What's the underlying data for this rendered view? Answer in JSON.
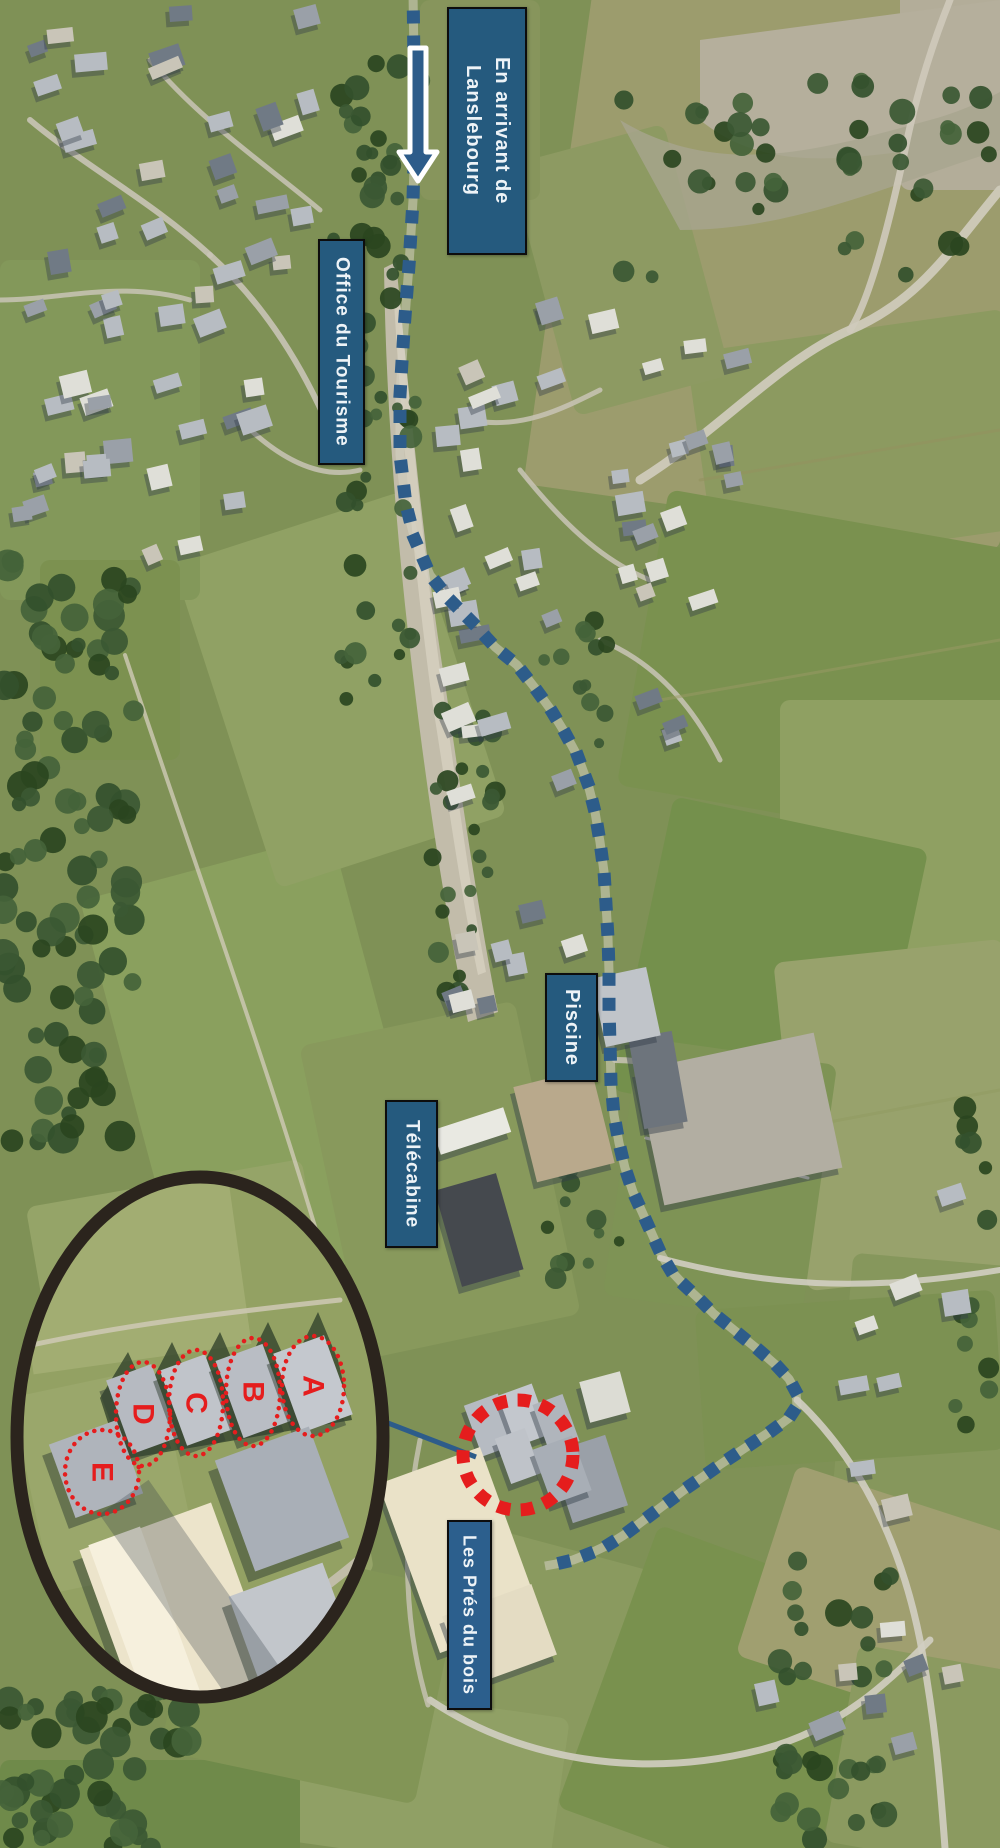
{
  "labels": {
    "arrival": {
      "line1": "En arrivant de",
      "line2": "Lanslebourg"
    },
    "tourism_office": "Office du Tourisme",
    "pool": "Piscine",
    "gondola": "Télécabine",
    "residence": "Les Prés du bois"
  },
  "colors": {
    "label_bg": "#255a7e",
    "label_bg_residence": "#2c5f8d",
    "label_text": "#edf3f7",
    "route_blue": "#2d5c8a",
    "marker_red": "#e51d1d",
    "magnifier_ring": "#2b241d",
    "arrow_fill": "#2d5c8a",
    "arrow_outline": "#ffffff"
  },
  "map": {
    "width": 1000,
    "height": 1848,
    "route": {
      "dash": 13,
      "step": 25,
      "waypoints": [
        [
          413,
          -8
        ],
        [
          414,
          60
        ],
        [
          415,
          130
        ],
        [
          413,
          200
        ],
        [
          409,
          265
        ],
        [
          404,
          330
        ],
        [
          400,
          395
        ],
        [
          400,
          455
        ],
        [
          406,
          505
        ],
        [
          415,
          540
        ],
        [
          430,
          575
        ],
        [
          450,
          600
        ],
        [
          472,
          622
        ],
        [
          495,
          647
        ],
        [
          517,
          665
        ],
        [
          535,
          688
        ],
        [
          551,
          710
        ],
        [
          565,
          733
        ],
        [
          578,
          757
        ],
        [
          588,
          784
        ],
        [
          595,
          812
        ],
        [
          600,
          842
        ],
        [
          604,
          872
        ],
        [
          606,
          904
        ],
        [
          608,
          938
        ],
        [
          609,
          972
        ],
        [
          609,
          1008
        ],
        [
          610,
          1045
        ],
        [
          611,
          1082
        ],
        [
          614,
          1115
        ],
        [
          619,
          1143
        ],
        [
          625,
          1168
        ],
        [
          633,
          1192
        ],
        [
          643,
          1214
        ],
        [
          652,
          1234
        ],
        [
          661,
          1254
        ],
        [
          671,
          1271
        ],
        [
          684,
          1285
        ],
        [
          699,
          1299
        ],
        [
          714,
          1314
        ],
        [
          729,
          1326
        ],
        [
          745,
          1339
        ],
        [
          761,
          1352
        ],
        [
          777,
          1366
        ],
        [
          789,
          1379
        ],
        [
          796,
          1392
        ],
        [
          797,
          1406
        ],
        [
          789,
          1418
        ],
        [
          774,
          1429
        ],
        [
          757,
          1440
        ],
        [
          739,
          1452
        ],
        [
          721,
          1464
        ],
        [
          704,
          1476
        ],
        [
          688,
          1487
        ],
        [
          672,
          1499
        ],
        [
          656,
          1511
        ],
        [
          640,
          1523
        ],
        [
          624,
          1535
        ],
        [
          608,
          1545
        ],
        [
          591,
          1553
        ],
        [
          573,
          1560
        ],
        [
          556,
          1564
        ],
        [
          545,
          1566
        ]
      ]
    },
    "arrow": {
      "points": "410,48 426,48 426,152 437,152 418,181 399,152 410,152"
    },
    "red_circle": {
      "cx": 518,
      "cy": 1455,
      "r": 55,
      "sw": 13,
      "dash": "13 10.5"
    },
    "connector": {
      "x1": 349,
      "y1": 1408,
      "x2": 476,
      "y2": 1457,
      "w": 5
    },
    "fields": [
      {
        "x": 560,
        "y": -40,
        "w": 480,
        "h": 560,
        "rot": 8,
        "f": "#9c9c6d"
      },
      {
        "x": 900,
        "y": -10,
        "w": 110,
        "h": 200,
        "rot": 0,
        "f": "#b3ad99"
      },
      {
        "x": 700,
        "y": 330,
        "w": 320,
        "h": 220,
        "rot": -8,
        "f": "#8c9a60"
      },
      {
        "x": 640,
        "y": 520,
        "w": 380,
        "h": 300,
        "rot": 10,
        "f": "#7a914f"
      },
      {
        "x": 780,
        "y": 700,
        "w": 240,
        "h": 260,
        "rot": 0,
        "f": "#8fa062"
      },
      {
        "x": 640,
        "y": 820,
        "w": 260,
        "h": 300,
        "rot": 12,
        "f": "#74904c"
      },
      {
        "x": 790,
        "y": 950,
        "w": 230,
        "h": 330,
        "rot": -6,
        "f": "#98a26c"
      },
      {
        "x": 620,
        "y": 1050,
        "w": 200,
        "h": 260,
        "rot": 8,
        "f": "#7e9355"
      },
      {
        "x": 840,
        "y": 1260,
        "w": 180,
        "h": 300,
        "rot": 5,
        "f": "#86975c"
      },
      {
        "x": 700,
        "y": 1300,
        "w": 300,
        "h": 160,
        "rot": -4,
        "f": "#7c9152"
      },
      {
        "x": 430,
        "y": 1560,
        "w": 320,
        "h": 300,
        "rot": 15,
        "f": "#8a9a5f"
      },
      {
        "x": 600,
        "y": 1560,
        "w": 260,
        "h": 300,
        "rot": 20,
        "f": "#79914e"
      },
      {
        "x": 760,
        "y": 1500,
        "w": 260,
        "h": 200,
        "rot": 18,
        "f": "#a09f70"
      },
      {
        "x": 840,
        "y": 1660,
        "w": 200,
        "h": 200,
        "rot": 10,
        "f": "#8b9a60"
      },
      {
        "x": 300,
        "y": 1700,
        "w": 260,
        "h": 160,
        "rot": 8,
        "f": "#90a065"
      },
      {
        "x": 0,
        "y": 1760,
        "w": 300,
        "h": 100,
        "rot": 0,
        "f": "#6f8a4a"
      },
      {
        "x": 130,
        "y": 860,
        "w": 260,
        "h": 420,
        "rot": -15,
        "f": "#8aa05e"
      },
      {
        "x": 60,
        "y": 1180,
        "w": 280,
        "h": 420,
        "rot": -10,
        "f": "#95a468"
      },
      {
        "x": 330,
        "y": 1020,
        "w": 220,
        "h": 320,
        "rot": -12,
        "f": "#88995c"
      },
      {
        "x": 220,
        "y": 520,
        "w": 240,
        "h": 340,
        "rot": -18,
        "f": "#90a164"
      },
      {
        "x": 0,
        "y": 260,
        "w": 200,
        "h": 340,
        "rot": 0,
        "f": "#83985a"
      },
      {
        "x": 540,
        "y": 140,
        "w": 160,
        "h": 260,
        "rot": -15,
        "f": "#8d9a62"
      },
      {
        "x": 420,
        "y": 0,
        "w": 120,
        "h": 200,
        "rot": 0,
        "f": "#87955c"
      },
      {
        "x": 180,
        "y": 1560,
        "w": 260,
        "h": 220,
        "rot": 12,
        "f": "#829556"
      },
      {
        "x": 40,
        "y": 560,
        "w": 140,
        "h": 200,
        "rot": 0,
        "f": "#7c9150"
      }
    ],
    "scree": [
      {
        "d": "M396,262 C410,400 422,540 446,690 C462,800 478,910 498,1012 L468,1022 C448,926 432,828 416,700 C398,556 386,412 384,268 Z",
        "f": "#c2bcaa",
        "o": 1
      },
      {
        "d": "M400,300 C412,430 424,560 444,698 C458,798 470,888 486,972 L478,975 C460,890 448,800 432,700 C414,566 402,436 394,302 Z",
        "f": "#d8d3c2",
        "o": 0.75
      },
      {
        "d": "M700,40 L1000,0 L1000,140 C880,150 780,185 700,120 Z",
        "f": "#b5af9c",
        "o": 1
      },
      {
        "d": "M620,120 C720,180 820,150 930,120 C960,112 985,100 1000,92 L1000,150 C900,180 800,230 680,230 Z",
        "f": "#a8a58e",
        "o": 0.8
      }
    ],
    "roads": [
      {
        "d": "M640,480 C720,430 780,360 850,330 C920,300 950,250 1000,190",
        "w": 9,
        "c": "#cfcabb",
        "o": 0.95
      },
      {
        "d": "M850,330 C870,300 890,220 905,150 C915,100 930,50 950,0",
        "w": 7,
        "c": "#cfcabb",
        "o": 0.9
      },
      {
        "d": "M660,1258 C780,1290 880,1290 1000,1270",
        "w": 6,
        "c": "#d2cec2",
        "o": 0.9
      },
      {
        "d": "M797,1400 C860,1460 900,1540 920,1640 C935,1720 940,1780 945,1848",
        "w": 7,
        "c": "#d2cec2",
        "o": 0.9
      },
      {
        "d": "M430,1700 C520,1760 640,1780 760,1750 C840,1730 890,1680 930,1640",
        "w": 7,
        "c": "#d2cec2",
        "o": 0.9
      },
      {
        "d": "M125,655 C200,880 280,1100 335,1295",
        "w": 4,
        "c": "#d0cab6",
        "o": 0.8
      },
      {
        "d": "M30,120 C90,170 150,200 210,255",
        "w": 6,
        "c": "#c9c4b6",
        "o": 0.9
      },
      {
        "d": "M210,255 C260,300 300,360 330,430",
        "w": 6,
        "c": "#c9c4b6",
        "o": 0.9
      },
      {
        "d": "M150,60 C200,120 260,160 320,210",
        "w": 5,
        "c": "#c9c4b6",
        "o": 0.85
      },
      {
        "d": "M0,300 C60,300 120,280 190,300",
        "w": 5,
        "c": "#c9c4b6",
        "o": 0.85
      },
      {
        "d": "M240,420 C280,460 320,480 360,470",
        "w": 5,
        "c": "#c9c4b6",
        "o": 0.85
      },
      {
        "d": "M470,420 C520,430 560,410 600,390",
        "w": 5,
        "c": "#c9c4b6",
        "o": 0.85
      },
      {
        "d": "M520,470 C560,520 600,560 650,580",
        "w": 5,
        "c": "#c9c4b6",
        "o": 0.85
      },
      {
        "d": "M600,640 C650,660 690,700 720,760",
        "w": 5,
        "c": "#c9c4b6",
        "o": 0.85
      },
      {
        "d": "M615,1060 C650,1060 680,1070 700,1090",
        "w": 6,
        "c": "#c9c4b6",
        "o": 0.85
      },
      {
        "d": "M420,1440 C400,1540 405,1630 428,1705",
        "w": 5,
        "c": "#c9c4b6",
        "o": 0.8
      },
      {
        "d": "M658,1072 L820,1112",
        "w": 3,
        "c": "#dad7cd",
        "o": 0.9
      },
      {
        "d": "M654,1094 L816,1134",
        "w": 3,
        "c": "#dad7cd",
        "o": 0.9
      },
      {
        "d": "M650,1116 L812,1156",
        "w": 3,
        "c": "#dad7cd",
        "o": 0.9
      },
      {
        "d": "M646,1138 L808,1178",
        "w": 3,
        "c": "#dad7cd",
        "o": 0.9
      },
      {
        "d": "M700,480 L1000,430",
        "w": 3,
        "c": "#93935f",
        "o": 0.6
      },
      {
        "d": "M660,700 L1000,640",
        "w": 3,
        "c": "#9a9a66",
        "o": 0.5
      },
      {
        "d": "M680,1150 L1000,1090",
        "w": 3,
        "c": "#8f9a60",
        "o": 0.5
      }
    ],
    "forest": [
      {
        "x": 0,
        "y": 560,
        "w": 135,
        "h": 585,
        "n": 95,
        "rmin": 7,
        "rmax": 16,
        "seed": 11
      },
      {
        "x": 0,
        "y": 1690,
        "w": 190,
        "h": 158,
        "n": 48,
        "rmin": 8,
        "rmax": 16,
        "seed": 22
      },
      {
        "x": 330,
        "y": 300,
        "w": 90,
        "h": 400,
        "n": 36,
        "rmin": 5,
        "rmax": 12,
        "seed": 33
      },
      {
        "x": 430,
        "y": 700,
        "w": 70,
        "h": 300,
        "n": 26,
        "rmin": 5,
        "rmax": 11,
        "seed": 44
      },
      {
        "x": 330,
        "y": 60,
        "w": 90,
        "h": 240,
        "n": 26,
        "rmin": 6,
        "rmax": 13,
        "seed": 55
      },
      {
        "x": 770,
        "y": 1550,
        "w": 120,
        "h": 298,
        "n": 32,
        "rmin": 7,
        "rmax": 14,
        "seed": 66
      },
      {
        "x": 540,
        "y": 620,
        "w": 80,
        "h": 140,
        "n": 12,
        "rmin": 5,
        "rmax": 11,
        "seed": 77
      },
      {
        "x": 545,
        "y": 1160,
        "w": 75,
        "h": 160,
        "n": 12,
        "rmin": 5,
        "rmax": 11,
        "seed": 88
      },
      {
        "x": 620,
        "y": 80,
        "w": 380,
        "h": 200,
        "n": 42,
        "rmin": 6,
        "rmax": 13,
        "seed": 99
      },
      {
        "x": 955,
        "y": 1080,
        "w": 45,
        "h": 420,
        "n": 14,
        "rmin": 6,
        "rmax": 12,
        "seed": 17
      }
    ],
    "clusters": [
      {
        "x": 5,
        "y": 5,
        "w": 315,
        "h": 515,
        "n": 46,
        "wmin": 16,
        "wmax": 34,
        "hmin": 12,
        "hmax": 24,
        "seed": 101
      },
      {
        "x": 430,
        "y": 290,
        "w": 260,
        "h": 520,
        "n": 32,
        "wmin": 16,
        "wmax": 32,
        "hmin": 12,
        "hmax": 24,
        "seed": 202
      },
      {
        "x": 610,
        "y": 330,
        "w": 150,
        "h": 280,
        "n": 14,
        "wmin": 14,
        "wmax": 28,
        "hmin": 12,
        "hmax": 22,
        "seed": 303
      },
      {
        "x": 440,
        "y": 830,
        "w": 170,
        "h": 220,
        "n": 10,
        "wmin": 14,
        "wmax": 28,
        "hmin": 12,
        "hmax": 22,
        "seed": 404
      },
      {
        "x": 740,
        "y": 1555,
        "w": 260,
        "h": 200,
        "n": 8,
        "wmin": 18,
        "wmax": 34,
        "hmin": 14,
        "hmax": 24,
        "seed": 505
      },
      {
        "x": 830,
        "y": 1150,
        "w": 170,
        "h": 380,
        "n": 8,
        "wmin": 18,
        "wmax": 34,
        "hmin": 14,
        "hmax": 26,
        "seed": 606
      },
      {
        "x": 0,
        "y": 450,
        "w": 220,
        "h": 120,
        "n": 8,
        "wmin": 16,
        "wmax": 30,
        "hmin": 12,
        "hmax": 20,
        "seed": 707
      }
    ],
    "special": [
      {
        "x": 435,
        "y": 1118,
        "w": 74,
        "h": 26,
        "rot": -18,
        "f": "#e9e9e2"
      },
      {
        "x": 447,
        "y": 1180,
        "w": 64,
        "h": 100,
        "rot": -16,
        "f": "#45494e"
      },
      {
        "x": 524,
        "y": 1076,
        "w": 80,
        "h": 98,
        "rot": -14,
        "f": "#b9a98c"
      },
      {
        "x": 648,
        "y": 1050,
        "w": 182,
        "h": 138,
        "rot": -12,
        "f": "#b2aea2"
      },
      {
        "x": 636,
        "y": 1034,
        "w": 44,
        "h": 92,
        "rot": -10,
        "f": "#6d747c"
      },
      {
        "x": 598,
        "y": 972,
        "w": 56,
        "h": 70,
        "rot": -12,
        "f": "#c0c4c9"
      },
      {
        "x": 560,
        "y": 1442,
        "w": 58,
        "h": 74,
        "rot": -18,
        "f": "#9aa0a8"
      },
      {
        "x": 472,
        "y": 1398,
        "w": 36,
        "h": 54,
        "rot": -20,
        "f": "#b6bbc2"
      },
      {
        "x": 506,
        "y": 1388,
        "w": 36,
        "h": 54,
        "rot": -20,
        "f": "#c3c7cd"
      },
      {
        "x": 540,
        "y": 1398,
        "w": 32,
        "h": 50,
        "rot": -20,
        "f": "#b0b5bc"
      },
      {
        "x": 502,
        "y": 1432,
        "w": 32,
        "h": 48,
        "rot": -20,
        "f": "#bfc3c9"
      },
      {
        "x": 541,
        "y": 1441,
        "w": 42,
        "h": 58,
        "rot": -20,
        "f": "#a8aeb6"
      },
      {
        "x": 406,
        "y": 1460,
        "w": 108,
        "h": 180,
        "rot": -20,
        "f": "#eae2c8"
      },
      {
        "x": 452,
        "y": 1598,
        "w": 95,
        "h": 75,
        "rot": -20,
        "f": "#e4dcc3"
      },
      {
        "x": 584,
        "y": 1376,
        "w": 42,
        "h": 42,
        "rot": -15,
        "f": "#dcdcd4"
      }
    ]
  },
  "inset": {
    "cx": 200,
    "cy": 1437,
    "rx": 183,
    "ry": 260,
    "ring_w": 13,
    "shapes": [
      {
        "t": "rect",
        "x": 10,
        "y": 1170,
        "w": 382,
        "h": 540,
        "f": "#93a163"
      },
      {
        "t": "rect",
        "x": 20,
        "y": 1180,
        "w": 220,
        "h": 180,
        "rot": -8,
        "f": "#a2ad72"
      },
      {
        "t": "rect",
        "x": 30,
        "y": 1380,
        "w": 150,
        "h": 200,
        "rot": -12,
        "f": "#9aa76b"
      },
      {
        "t": "path",
        "d": "M18,1348 C120,1325 230,1312 340,1300",
        "w": 5,
        "c": "#cfc9b5",
        "o": 0.85
      },
      {
        "t": "path",
        "d": "M140,1700 C230,1655 300,1610 365,1555",
        "w": 9,
        "c": "#c6c0af",
        "o": 0.9
      },
      {
        "t": "poly",
        "pts": "100,1398 128,1352 146,1392 172,1342 192,1385 220,1332 240,1378 268,1322 290,1370 318,1312 338,1360 352,1420 120,1460",
        "f": "#2c3e28",
        "o": 0.75
      },
      {
        "t": "rect",
        "x": 118,
        "y": 1370,
        "w": 48,
        "h": 78,
        "rot": -20,
        "f": "#b6bac1",
        "sh": 1
      },
      {
        "t": "rect",
        "x": 172,
        "y": 1360,
        "w": 48,
        "h": 80,
        "rot": -20,
        "f": "#c0c4ca",
        "sh": 1
      },
      {
        "t": "rect",
        "x": 228,
        "y": 1350,
        "w": 50,
        "h": 82,
        "rot": -20,
        "f": "#b9bdc4",
        "sh": 1
      },
      {
        "t": "rect",
        "x": 286,
        "y": 1342,
        "w": 54,
        "h": 84,
        "rot": -20,
        "f": "#c4c8ce",
        "sh": 1
      },
      {
        "t": "rect",
        "x": 60,
        "y": 1430,
        "w": 72,
        "h": 78,
        "rot": -20,
        "f": "#afb4bb",
        "sh": 1
      },
      {
        "t": "rect",
        "x": 232,
        "y": 1440,
        "w": 100,
        "h": 118,
        "rot": -20,
        "f": "#a9afb7",
        "sh": 1
      },
      {
        "t": "rect",
        "x": 112,
        "y": 1520,
        "w": 140,
        "h": 215,
        "rot": -20,
        "f": "#ece4cb",
        "sh": 1
      },
      {
        "t": "rect",
        "x": 120,
        "y": 1530,
        "w": 55,
        "h": 195,
        "rot": -20,
        "f": "#f6f0dd"
      },
      {
        "t": "rect",
        "x": 252,
        "y": 1575,
        "w": 100,
        "h": 155,
        "rot": -20,
        "f": "#c2c6cb",
        "sh": 1
      },
      {
        "t": "rect",
        "x": 180,
        "y": 1470,
        "w": 60,
        "h": 300,
        "rot": -35,
        "f": "#2d3a46",
        "o": 0.28
      }
    ],
    "markers": [
      {
        "label": "A",
        "cx": 313,
        "cy": 1386,
        "rx": 31,
        "ry": 50
      },
      {
        "label": "B",
        "cx": 253,
        "cy": 1392,
        "rx": 27,
        "ry": 54
      },
      {
        "label": "C",
        "cx": 196,
        "cy": 1403,
        "rx": 27,
        "ry": 53
      },
      {
        "label": "D",
        "cx": 143,
        "cy": 1414,
        "rx": 27,
        "ry": 52
      },
      {
        "label": "E",
        "cx": 102,
        "cy": 1472,
        "rx": 37,
        "ry": 42
      }
    ]
  }
}
